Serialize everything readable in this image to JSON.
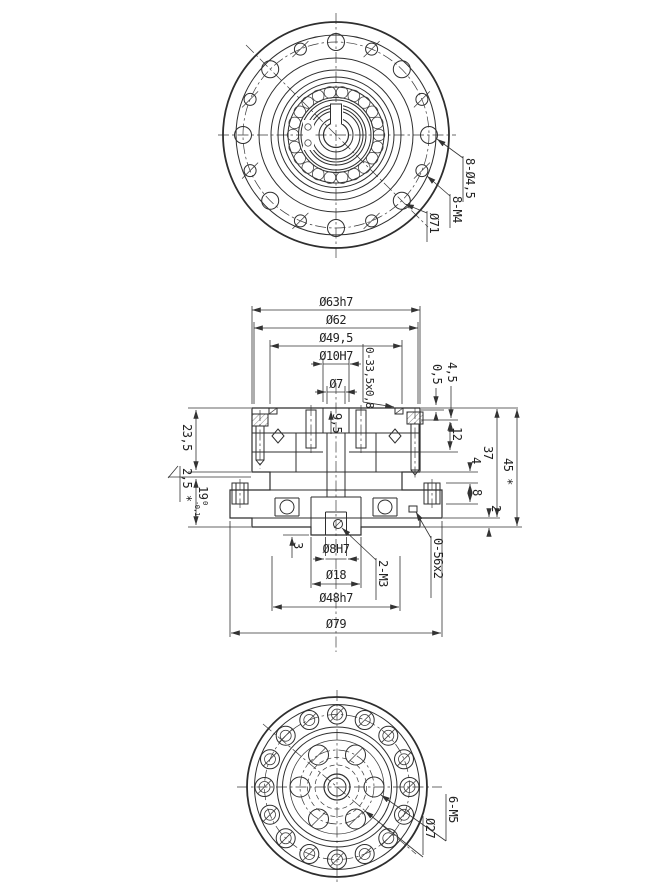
{
  "section": {
    "top": {
      "d63": "Ø63h7",
      "d62": "Ø62",
      "d49_5": "Ø49,5",
      "d10": "Ø10H7",
      "d7": "Ø7",
      "depth": "9,5",
      "oring": "0-33,5x0,8"
    },
    "right": {
      "r05": "0,5",
      "r45": "4,5",
      "r12": "12",
      "r37": "37",
      "r45s": "45 *",
      "r4": "4",
      "r8": "8",
      "r2": "2"
    },
    "left": {
      "l235": "23,5",
      "l25": "2,5 *",
      "l19": "19",
      "l19_tol_up": "0",
      "l19_tol_low": "-0,1"
    },
    "bottom": {
      "b3": "3",
      "d8": "Ø8H7",
      "d18": "Ø18",
      "d48": "Ø48h7",
      "d79": "Ø79",
      "m3": "2-M3",
      "oring": "0-56x2"
    }
  },
  "top_view": {
    "clearance_holes": "8-Ø4,5",
    "tapped_holes": "8-M4",
    "bolt_circle": "Ø71"
  },
  "bottom_view": {
    "tapped_holes": "6-M5",
    "bolt_circle": "Ø27"
  }
}
